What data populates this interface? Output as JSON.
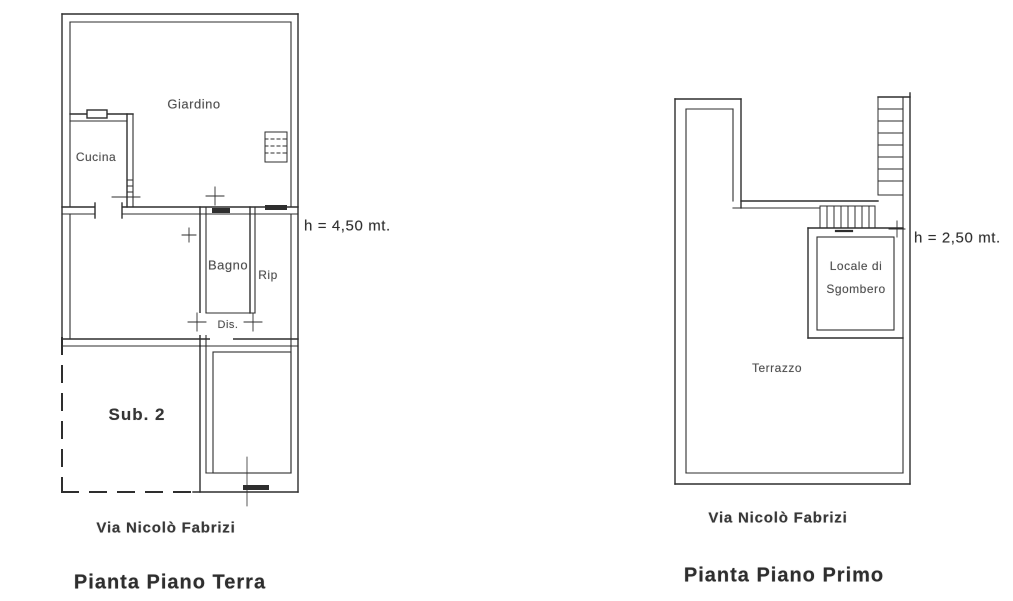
{
  "document": {
    "background_color": "#ffffff",
    "line_color": "#2e2e2e",
    "kind": "scanned floor plan drawing"
  },
  "ground_floor": {
    "title": "Pianta Piano Terra",
    "street": "Via Nicolò Fabrizi",
    "height_note": "h = 4,50 mt.",
    "rooms": {
      "garden": "Giardino",
      "kitchen": "Cucina",
      "bathroom": "Bagno",
      "closet": "Rip",
      "hallway": "Dis.",
      "subunit": "Sub. 2"
    }
  },
  "first_floor": {
    "title": "Pianta Piano Primo",
    "street": "Via Nicolò Fabrizi",
    "height_note": "h = 2,50 mt.",
    "rooms": {
      "storage_line1": "Locale di",
      "storage_line2": "Sgombero",
      "terrace": "Terrazzo"
    }
  }
}
